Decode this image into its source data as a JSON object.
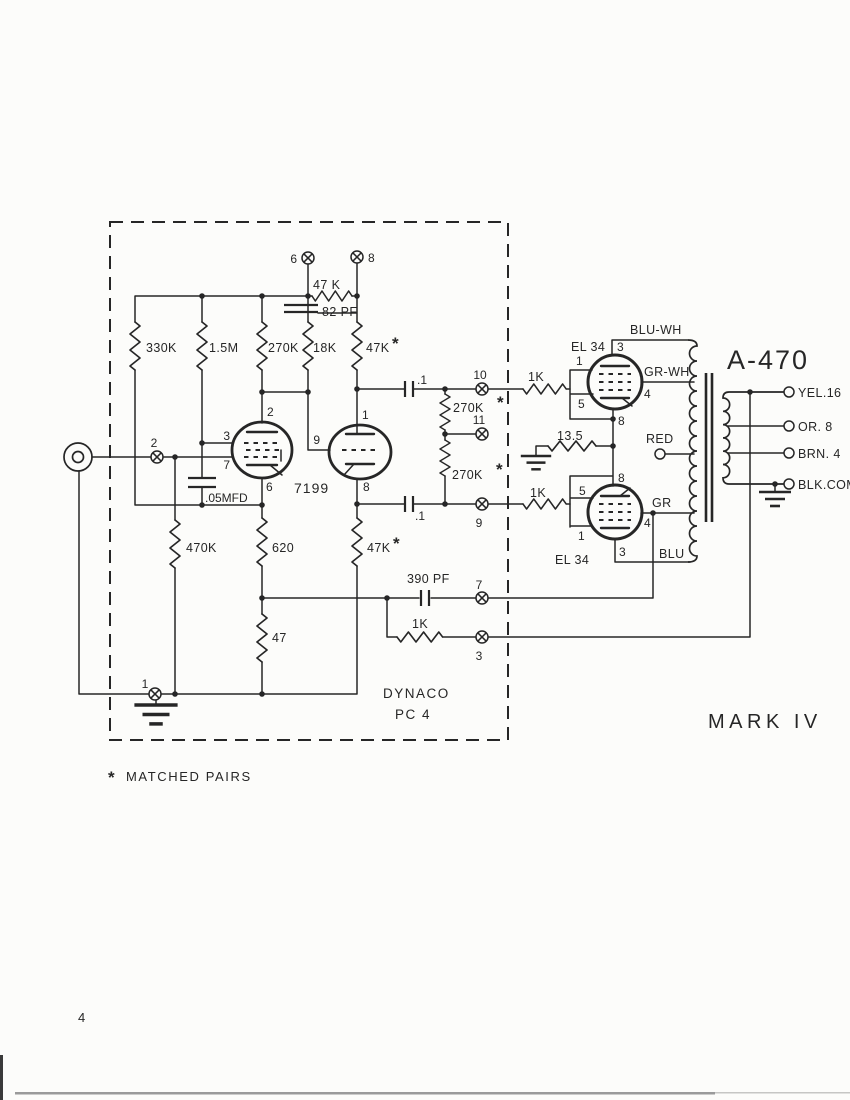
{
  "colors": {
    "ink": "#262626",
    "paper": "#fcfcfa",
    "scanline": "#9a9a9a"
  },
  "doc": {
    "page_number": "4",
    "board_line1": "DYNACO",
    "board_line2": "PC 4",
    "model_name": "MARK IV",
    "note_star": "*",
    "note_text": "MATCHED PAIRS",
    "output_transformer": "A-470",
    "star": "*"
  },
  "tubes": {
    "driver": "7199",
    "output_upper": "EL 34",
    "output_lower": "EL 34"
  },
  "labels": {
    "r330k": "330K",
    "r1_5m": "1.5M",
    "r270k": "270K",
    "r18k": "18K",
    "r47k_top": "47 K",
    "c82pf": "82 PF",
    "r47k_upper": "47K",
    "c_05mfd": ".05MFD",
    "r470k": "470K",
    "r620": "620",
    "r47": "47",
    "r47k_lower": "47K",
    "c_1_upper": ".1",
    "c_1_lower": ".1",
    "r270k_a": "270K",
    "r270k_b": "270K",
    "c390pf": "390 PF",
    "r1k_fb": "1K",
    "r1k_upper": "1K",
    "r1k_lower": "1K",
    "r13_5": "13.5"
  },
  "terminals": {
    "t1": "1",
    "t2": "2",
    "t3": "3",
    "t6": "6",
    "t7": "7",
    "t8": "8",
    "t9": "9",
    "t10": "10",
    "t11": "11"
  },
  "pins": {
    "v7199": {
      "p2": "2",
      "p3": "3",
      "p7": "7",
      "p6": "6",
      "p1": "1",
      "p9": "9",
      "p8": "8"
    },
    "el34_upper": {
      "p3": "3",
      "p1": "1",
      "p5": "5",
      "p4": "4",
      "p8": "8"
    },
    "el34_lower": {
      "p8": "8",
      "p5": "5",
      "p1": "1",
      "p4": "4",
      "p3": "3"
    }
  },
  "wire_colors": {
    "blu_wh": "BLU-WH",
    "gr_wh": "GR-WH",
    "red": "RED",
    "gr": "GR",
    "blu": "BLU"
  },
  "outputs": {
    "yel": "YEL.16",
    "or": "OR. 8",
    "brn": "BRN. 4",
    "blk": "BLK.COM"
  }
}
